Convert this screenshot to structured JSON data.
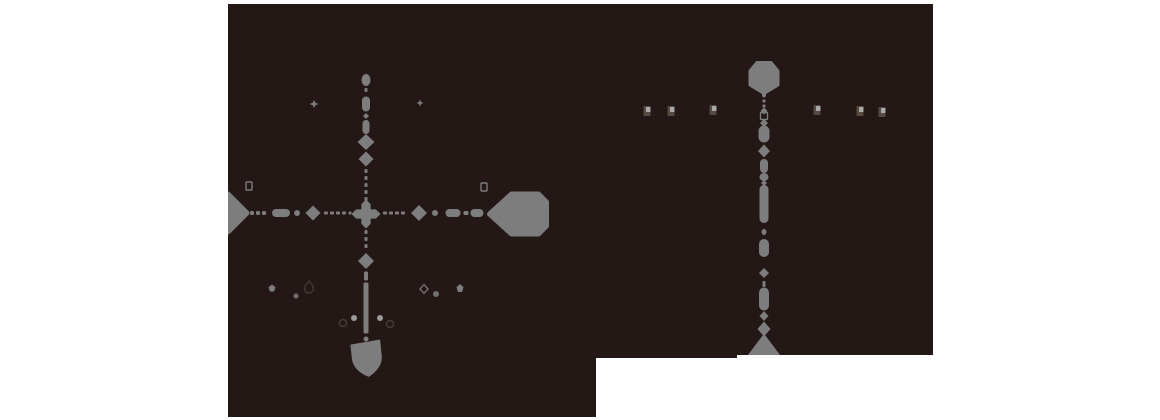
{
  "canvas": {
    "width": 1160,
    "height": 420,
    "background": "#ffffff"
  },
  "colors": {
    "panelBg": "#231815",
    "gray": "#7d7d7d",
    "grayMid": "#6f6f6f",
    "grayLight": "#9a9a9a",
    "dark": "#4a3b35",
    "poiDark": "#584a41",
    "poiLight": "#a9a9a9"
  },
  "panels": [
    {
      "name": "map-panel-left",
      "x": 228,
      "y": 4,
      "width": 368,
      "height": 413
    },
    {
      "name": "map-panel-right-lower",
      "x": 596,
      "y": 4,
      "width": 141,
      "height": 354
    },
    {
      "name": "map-panel-right",
      "x": 737,
      "y": 4,
      "width": 196,
      "height": 351
    }
  ],
  "routes": [
    {
      "name": "route-left-vertical",
      "items": [
        {
          "t": "dot",
          "x": 366,
          "y": 80,
          "w": 9,
          "h": 12,
          "n": "route-dot"
        },
        {
          "t": "dash",
          "x": 366,
          "y": 90,
          "w": 3,
          "h": 4,
          "n": "route-dash"
        },
        {
          "t": "capsule",
          "x": 366,
          "y": 104,
          "w": 8,
          "h": 15,
          "n": "route-segment"
        },
        {
          "t": "cross",
          "x": 366,
          "y": 116,
          "w": 5,
          "h": 5,
          "n": "route-tick"
        },
        {
          "t": "capsule",
          "x": 366,
          "y": 127,
          "w": 7,
          "h": 14,
          "n": "route-segment"
        },
        {
          "t": "diamond",
          "x": 366,
          "y": 142,
          "w": 17,
          "h": 16,
          "n": "station-diamond-marker",
          "i": true
        },
        {
          "t": "diamond",
          "x": 366,
          "y": 159,
          "w": 15,
          "h": 15,
          "n": "station-diamond-marker",
          "i": true
        },
        {
          "t": "dash",
          "x": 366,
          "y": 171,
          "w": 3,
          "h": 4,
          "n": "route-dash"
        },
        {
          "t": "dash",
          "x": 366,
          "y": 178,
          "w": 3,
          "h": 4,
          "n": "route-dash"
        },
        {
          "t": "dash",
          "x": 366,
          "y": 185,
          "w": 3,
          "h": 4,
          "n": "route-dash"
        },
        {
          "t": "dash",
          "x": 366,
          "y": 192,
          "w": 3,
          "h": 4,
          "n": "route-dash"
        },
        {
          "t": "dash",
          "x": 366,
          "y": 199,
          "w": 3,
          "h": 4,
          "n": "route-dash"
        },
        {
          "t": "diamond4",
          "x": 366,
          "y": 214,
          "w": 29,
          "h": 29,
          "n": "interchange-diamond-marker",
          "i": true
        },
        {
          "t": "dash",
          "x": 366,
          "y": 232,
          "w": 3,
          "h": 4,
          "n": "route-dash"
        },
        {
          "t": "dash",
          "x": 366,
          "y": 239,
          "w": 3,
          "h": 4,
          "n": "route-dash"
        },
        {
          "t": "dash",
          "x": 366,
          "y": 246,
          "w": 3,
          "h": 4,
          "n": "route-dash"
        },
        {
          "t": "diamond",
          "x": 366,
          "y": 261,
          "w": 16,
          "h": 16,
          "n": "station-diamond-marker",
          "i": true
        },
        {
          "t": "dash",
          "x": 366,
          "y": 276,
          "w": 4,
          "h": 9,
          "n": "route-dash"
        },
        {
          "t": "bar",
          "x": 366,
          "y": 308,
          "w": 5,
          "h": 51,
          "n": "route-solid-segment"
        },
        {
          "t": "dot",
          "x": 366,
          "y": 339,
          "w": 5,
          "h": 5,
          "n": "route-dot"
        },
        {
          "t": "shield",
          "x": 367,
          "y": 359,
          "w": 30,
          "h": 36,
          "rot": -6,
          "n": "route-shield-badge",
          "i": true
        }
      ]
    },
    {
      "name": "route-left-horizontal",
      "items": [
        {
          "t": "tag",
          "x": 228,
          "y": 213,
          "w": 38,
          "h": 38,
          "dir": "right",
          "n": "route-badge-clipped",
          "i": true
        },
        {
          "t": "dash",
          "x": 252,
          "y": 213,
          "w": 4,
          "h": 4,
          "n": "route-dash"
        },
        {
          "t": "dash",
          "x": 258,
          "y": 213,
          "w": 4,
          "h": 4,
          "n": "route-dash"
        },
        {
          "t": "dash",
          "x": 264,
          "y": 213,
          "w": 4,
          "h": 4,
          "n": "route-dash"
        },
        {
          "t": "capsule",
          "x": 281,
          "y": 213,
          "w": 18,
          "h": 8,
          "n": "route-segment"
        },
        {
          "t": "dot",
          "x": 297,
          "y": 213,
          "w": 6,
          "h": 6,
          "n": "route-dot"
        },
        {
          "t": "diamond",
          "x": 313,
          "y": 213,
          "w": 15,
          "h": 15,
          "n": "station-diamond-marker",
          "i": true
        },
        {
          "t": "dash",
          "x": 326,
          "y": 213,
          "w": 4,
          "h": 3,
          "n": "route-dash"
        },
        {
          "t": "dash",
          "x": 332,
          "y": 213,
          "w": 4,
          "h": 3,
          "n": "route-dash"
        },
        {
          "t": "dash",
          "x": 338,
          "y": 213,
          "w": 4,
          "h": 3,
          "n": "route-dash"
        },
        {
          "t": "dash",
          "x": 344,
          "y": 213,
          "w": 4,
          "h": 3,
          "n": "route-dash"
        },
        {
          "t": "dash",
          "x": 350,
          "y": 213,
          "w": 3,
          "h": 3,
          "n": "route-dash"
        },
        {
          "t": "dash",
          "x": 385,
          "y": 213,
          "w": 4,
          "h": 3,
          "n": "route-dash"
        },
        {
          "t": "dash",
          "x": 391,
          "y": 213,
          "w": 4,
          "h": 3,
          "n": "route-dash"
        },
        {
          "t": "dash",
          "x": 397,
          "y": 213,
          "w": 4,
          "h": 3,
          "n": "route-dash"
        },
        {
          "t": "dash",
          "x": 403,
          "y": 213,
          "w": 4,
          "h": 3,
          "n": "route-dash"
        },
        {
          "t": "diamond",
          "x": 419,
          "y": 213,
          "w": 16,
          "h": 16,
          "n": "station-diamond-marker",
          "i": true
        },
        {
          "t": "dot",
          "x": 435,
          "y": 213,
          "w": 6,
          "h": 6,
          "n": "route-dot"
        },
        {
          "t": "capsule",
          "x": 453,
          "y": 213,
          "w": 15,
          "h": 8,
          "n": "route-segment"
        },
        {
          "t": "dash",
          "x": 466,
          "y": 213,
          "w": 5,
          "h": 4,
          "n": "route-dash"
        },
        {
          "t": "capsule",
          "x": 477,
          "y": 213,
          "w": 13,
          "h": 8,
          "n": "route-segment"
        },
        {
          "t": "tag",
          "x": 518,
          "y": 214,
          "w": 57,
          "h": 40,
          "dir": "left",
          "n": "route-badge",
          "i": true
        }
      ]
    },
    {
      "name": "route-right-vertical",
      "items": [
        {
          "t": "hexv",
          "x": 764,
          "y": 78,
          "w": 28,
          "h": 31,
          "n": "hexagon-route-badge",
          "i": true
        },
        {
          "t": "dot",
          "x": 764,
          "y": 95,
          "w": 4,
          "h": 5,
          "n": "route-dot"
        },
        {
          "t": "dash",
          "x": 764,
          "y": 101,
          "w": 3,
          "h": 3,
          "n": "route-dash"
        },
        {
          "t": "dash",
          "x": 764,
          "y": 106,
          "w": 3,
          "h": 3,
          "n": "route-dash"
        },
        {
          "t": "diamond",
          "x": 764,
          "y": 111,
          "w": 7,
          "h": 7,
          "n": "route-node"
        },
        {
          "t": "sqo",
          "x": 764,
          "y": 116,
          "w": 7,
          "h": 7,
          "n": "hollow-square-marker"
        },
        {
          "t": "diamond",
          "x": 764,
          "y": 123,
          "w": 8,
          "h": 8,
          "n": "route-node"
        },
        {
          "t": "capsule",
          "x": 764,
          "y": 134,
          "w": 11,
          "h": 17,
          "n": "route-segment"
        },
        {
          "t": "diamond",
          "x": 764,
          "y": 151,
          "w": 12,
          "h": 13,
          "n": "station-diamond-marker",
          "i": true
        },
        {
          "t": "capsule",
          "x": 764,
          "y": 166,
          "w": 8,
          "h": 14,
          "n": "route-segment"
        },
        {
          "t": "dot",
          "x": 764,
          "y": 177,
          "w": 9,
          "h": 8,
          "n": "route-dot"
        },
        {
          "t": "cross",
          "x": 764,
          "y": 183,
          "w": 5,
          "h": 5,
          "n": "route-tick"
        },
        {
          "t": "capsule",
          "x": 764,
          "y": 204,
          "w": 9,
          "h": 38,
          "n": "route-segment"
        },
        {
          "t": "dot",
          "x": 764,
          "y": 232,
          "w": 5,
          "h": 6,
          "n": "route-dot"
        },
        {
          "t": "capsule",
          "x": 764,
          "y": 248,
          "w": 10,
          "h": 18,
          "n": "route-segment"
        },
        {
          "t": "diamond",
          "x": 764,
          "y": 273,
          "w": 10,
          "h": 10,
          "n": "route-node"
        },
        {
          "t": "dash",
          "x": 764,
          "y": 284,
          "w": 3,
          "h": 6,
          "n": "route-dash"
        },
        {
          "t": "capsule",
          "x": 764,
          "y": 299,
          "w": 10,
          "h": 23,
          "n": "route-segment"
        },
        {
          "t": "diamond",
          "x": 764,
          "y": 316,
          "w": 9,
          "h": 10,
          "n": "route-node"
        },
        {
          "t": "diamond",
          "x": 764,
          "y": 329,
          "w": 13,
          "h": 15,
          "n": "station-diamond-marker",
          "i": true
        },
        {
          "t": "tri",
          "x": 764,
          "y": 347,
          "w": 30,
          "h": 20,
          "n": "route-shield-badge-clipped",
          "i": true
        }
      ]
    }
  ],
  "glyphs": [
    {
      "t": "star4",
      "x": 314,
      "y": 104,
      "w": 9,
      "h": 8,
      "c": "gray",
      "n": "sparkle-icon",
      "i": true
    },
    {
      "t": "star4",
      "x": 420,
      "y": 103,
      "w": 7,
      "h": 7,
      "c": "gray",
      "n": "sparkle-icon",
      "i": true
    },
    {
      "t": "sqo",
      "x": 249,
      "y": 186,
      "w": 6,
      "h": 8,
      "c": "gray",
      "n": "small-square-marker-icon",
      "i": true
    },
    {
      "t": "sqo",
      "x": 484,
      "y": 187,
      "w": 6,
      "h": 8,
      "c": "gray",
      "n": "small-square-marker-icon",
      "i": true
    },
    {
      "t": "pent",
      "x": 272,
      "y": 288,
      "w": 7,
      "h": 7,
      "c": "gray",
      "n": "poi-icon",
      "i": true
    },
    {
      "t": "dropo",
      "x": 309,
      "y": 287,
      "w": 9,
      "h": 12,
      "c": "dark",
      "n": "droplet-outline-icon",
      "i": true
    },
    {
      "t": "dot",
      "x": 296,
      "y": 296,
      "w": 5,
      "h": 5,
      "c": "grayMid",
      "n": "poi-dot",
      "i": true
    },
    {
      "t": "diao",
      "x": 424,
      "y": 289,
      "w": 8,
      "h": 9,
      "c": "grayMid",
      "n": "diamond-outline-icon",
      "i": true
    },
    {
      "t": "dot",
      "x": 436,
      "y": 294,
      "w": 6,
      "h": 6,
      "c": "grayMid",
      "n": "poi-dot",
      "i": true
    },
    {
      "t": "pent",
      "x": 460,
      "y": 288,
      "w": 7,
      "h": 8,
      "c": "gray",
      "n": "poi-icon",
      "i": true
    },
    {
      "t": "dot",
      "x": 354,
      "y": 318,
      "w": 6,
      "h": 6,
      "c": "grayLight",
      "n": "poi-dot",
      "i": true
    },
    {
      "t": "dot",
      "x": 380,
      "y": 318,
      "w": 6,
      "h": 6,
      "c": "grayLight",
      "n": "poi-dot",
      "i": true
    },
    {
      "t": "cro",
      "x": 343,
      "y": 323,
      "w": 7,
      "h": 7,
      "c": "dark",
      "n": "ring-outline-icon",
      "i": true
    },
    {
      "t": "cro",
      "x": 390,
      "y": 324,
      "w": 7,
      "h": 7,
      "c": "dark",
      "n": "ring-outline-icon",
      "i": true
    },
    {
      "t": "poi",
      "x": 647,
      "y": 111,
      "n": "building-poi-icon",
      "i": true
    },
    {
      "t": "poi",
      "x": 671,
      "y": 111,
      "n": "building-poi-icon",
      "i": true
    },
    {
      "t": "poi",
      "x": 713,
      "y": 110,
      "n": "building-poi-icon",
      "i": true
    },
    {
      "t": "poi",
      "x": 817,
      "y": 110,
      "n": "building-poi-icon",
      "i": true
    },
    {
      "t": "poi",
      "x": 860,
      "y": 111,
      "n": "building-poi-icon",
      "i": true
    },
    {
      "t": "poi",
      "x": 882,
      "y": 112,
      "n": "building-poi-icon",
      "i": true
    }
  ]
}
